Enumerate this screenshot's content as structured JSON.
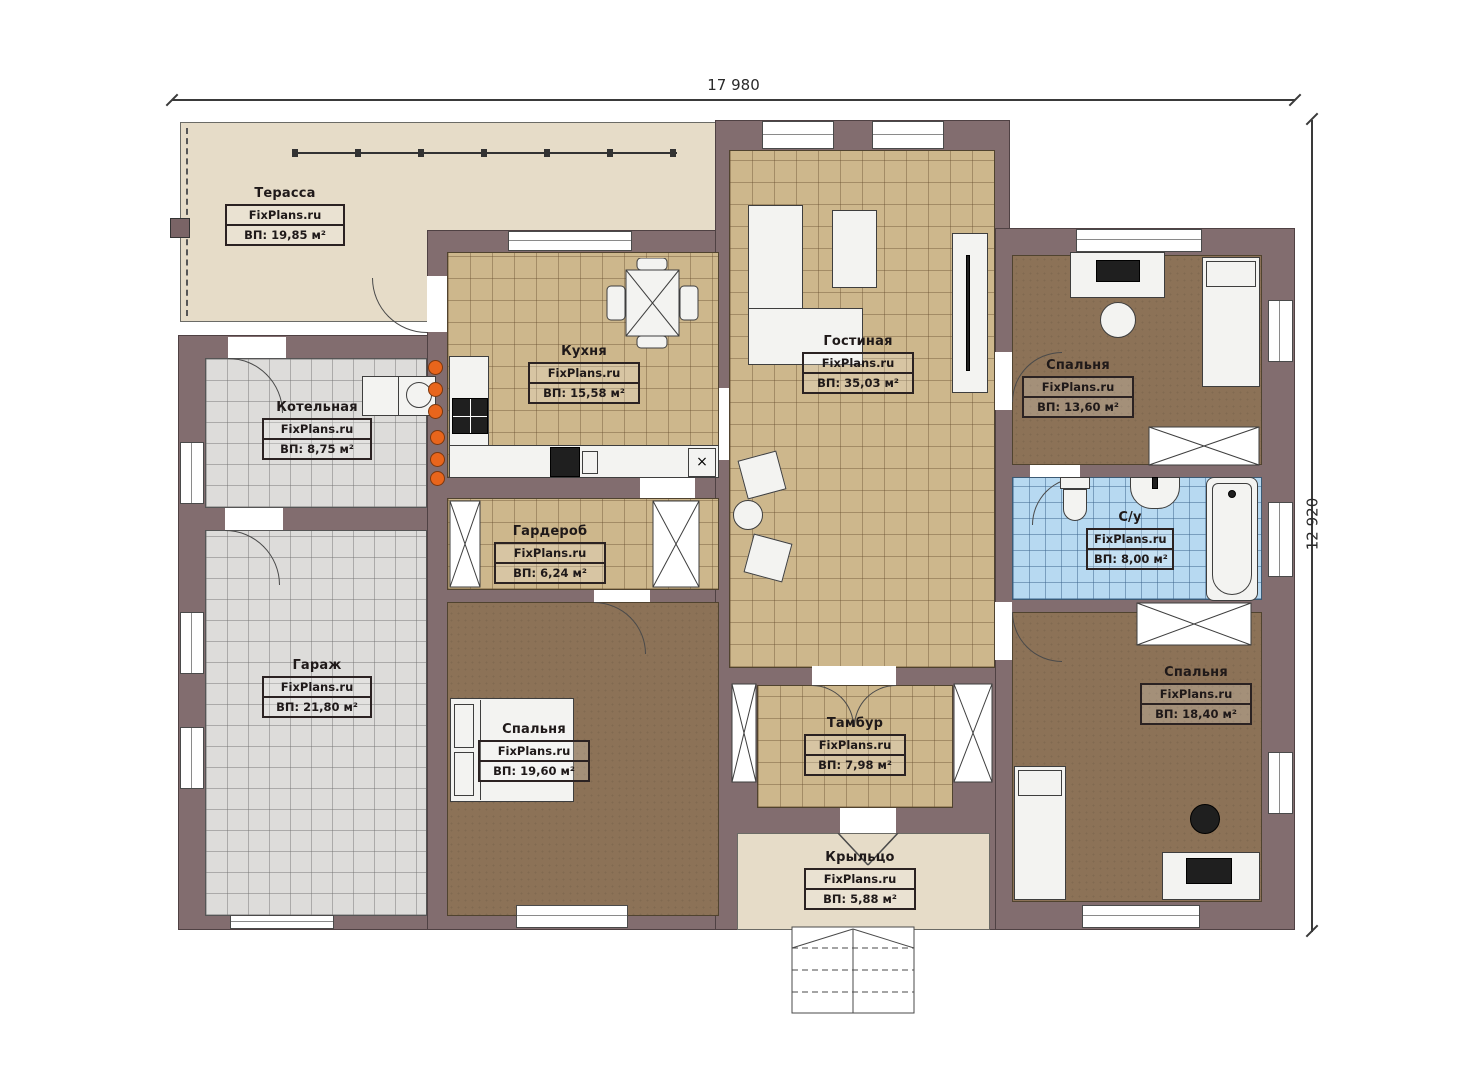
{
  "branding": "FixPlans.ru",
  "dimensions": {
    "width": "17 980",
    "height": "12 920"
  },
  "rooms": [
    {
      "id": "terrace",
      "name": "Терасса",
      "area": "ВП: 19,85 м²"
    },
    {
      "id": "boiler",
      "name": "Котельная",
      "area": "ВП: 8,75 м²"
    },
    {
      "id": "garage",
      "name": "Гараж",
      "area": "ВП: 21,80 м²"
    },
    {
      "id": "kitchen",
      "name": "Кухня",
      "area": "ВП: 15,58 м²"
    },
    {
      "id": "wardrobe",
      "name": "Гардероб",
      "area": "ВП: 6,24 м²"
    },
    {
      "id": "bedroom1",
      "name": "Спальня",
      "area": "ВП: 19,60 м²"
    },
    {
      "id": "living",
      "name": "Гостиная",
      "area": "ВП: 35,03 м²"
    },
    {
      "id": "vestibule",
      "name": "Тамбур",
      "area": "ВП: 7,98 м²"
    },
    {
      "id": "porch",
      "name": "Крыльцо",
      "area": "ВП: 5,88 м²"
    },
    {
      "id": "bedroom2",
      "name": "Спальня",
      "area": "ВП: 13,60 м²"
    },
    {
      "id": "bathroom",
      "name": "С/у",
      "area": "ВП: 8,00 м²"
    },
    {
      "id": "bedroom3",
      "name": "Спальня",
      "area": "ВП: 18,40 м²"
    }
  ],
  "colors": {
    "wall": "#826d6f",
    "tile_tan": "#cdb78c",
    "tile_grey": "#dddcda",
    "tile_blue": "#b7d9f1",
    "floor_brown": "#8c7257",
    "floor_beige": "#e6dcc8",
    "accent_manifold": "#e8651c"
  }
}
